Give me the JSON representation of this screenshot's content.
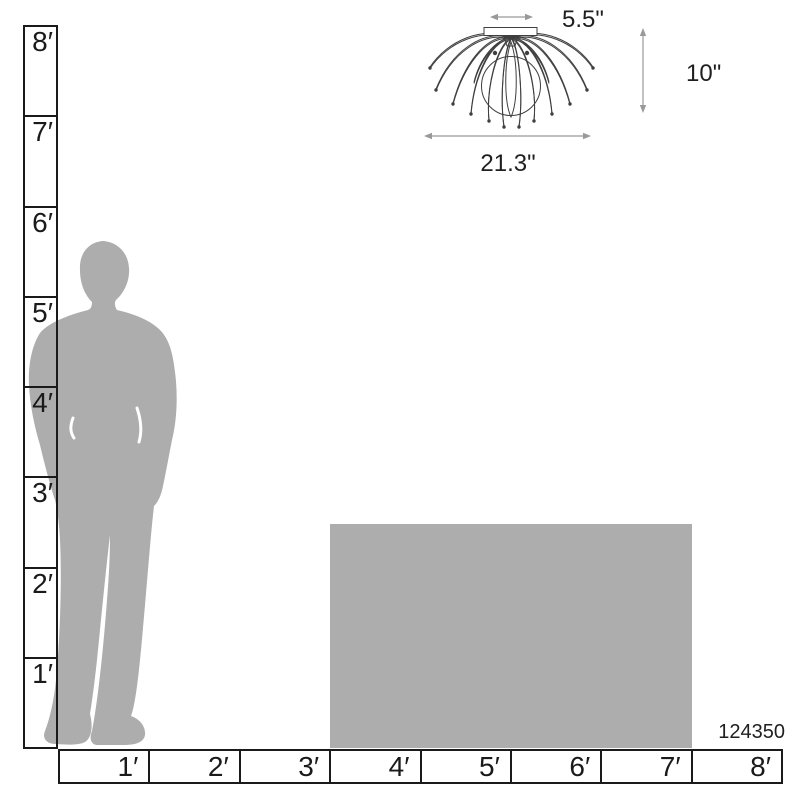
{
  "title": "Ceiling light scale dimension diagram",
  "product": {
    "sku": "124350"
  },
  "fixture": {
    "icon": "flush-mount-ceiling-light-line-drawing",
    "dimensions": {
      "canopy_width": "5.5\"",
      "height": "10\"",
      "width": "21.3\""
    }
  },
  "rulers": {
    "vertical": {
      "unit": "feet",
      "labels": [
        "8′",
        "7′",
        "6′",
        "5′",
        "4′",
        "3′",
        "2′",
        "1′"
      ]
    },
    "horizontal": {
      "unit": "feet",
      "labels": [
        "1′",
        "2′",
        "3′",
        "4′",
        "5′",
        "6′",
        "7′",
        "8′"
      ]
    }
  },
  "icons": {
    "person": "standing-man-silhouette",
    "furniture": "table-scale-block"
  },
  "colors": {
    "silhouette": "#adadad",
    "furniture": "#adadad",
    "ruler_line": "#1a1a1a",
    "drawing_line": "#3f3f3f",
    "dim_arrow": "#999999",
    "text": "#1f1f1f",
    "background": "#ffffff"
  }
}
